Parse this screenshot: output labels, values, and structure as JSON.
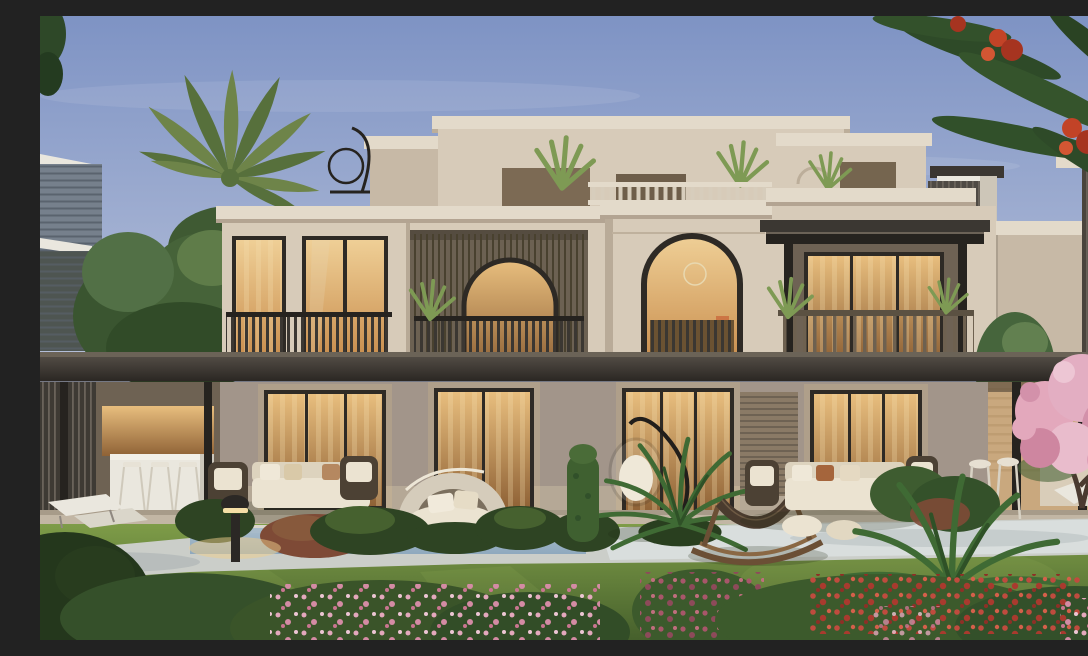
{
  "scene": {
    "type": "photorealistic architectural exterior rendering",
    "setting": "Twilight garden view of a modern two-storey stucco villa with recessed roof-terrace level, warm interior lighting, pergolas and landscaped lawn",
    "lighting": "dusk sky, warm amber light glowing through all glazing, bollard path light lit",
    "elements": [
      "sky at dusk",
      "neighbor building left with louvers",
      "neighbor villa right with louver panel",
      "palm tree",
      "green trees",
      "flame tree branch with red blossoms overhanging top right",
      "villa penthouse level with parapet plants",
      "rooftop hanging chair silhouette",
      "roof balustrade",
      "left wing with two lit windows and slatted balcony railing",
      "recessed loggia with arched opening",
      "center tower with large arched window and ring chandelier",
      "right wing covered balcony with posts and wood railing",
      "continuous dark shade canopy",
      "four lit sliding glass doors on ground floor",
      "roller shade panel",
      "left pergola with bar counter and stools",
      "right pergola with bar stools and planter",
      "stone terrace",
      "reflecting pool strip",
      "light garden path",
      "lawn",
      "canopy daybed",
      "hanging egg chair",
      "wooden hammock",
      "outdoor sofa sets with wicker chairs",
      "sun loungers",
      "bollard light with warm glow",
      "topiary column",
      "two large ferns",
      "hedge row",
      "rust shrub",
      "pink blossom tree",
      "flower beds pink red and magenta"
    ]
  },
  "canvas": {
    "width": 1088,
    "height": 624
  },
  "palette": {
    "sky_top": "#7E93C4",
    "sky_bottom": "#BDC6DC",
    "facade_light": "#D7CBB9",
    "facade_mid": "#C7B9A6",
    "facade_shadow": "#A2958A",
    "cornice_light": "#E3DACA",
    "dark_wood": "#3B3732",
    "darker_wood": "#26231F",
    "rail_wood": "#6E6150",
    "frame_dark": "#2E2A25",
    "window_glow_light": "#EFCF96",
    "window_glow": "#C98E4E",
    "window_glow_deep": "#8F6236",
    "grass_light": "#7E9C48",
    "grass_dark": "#46602C",
    "hedge_dark": "#2E4423",
    "fern_green": "#3F6A34",
    "palm_green": "#6E8449",
    "palm_dark": "#57703C",
    "leaf_highlight": "#5C8440",
    "path_light": "#CBCEC9",
    "path_bright": "#DCE0E0",
    "path_shade": "#9BA4A9",
    "pool_blue": "#8FA9BE",
    "blossom_pink": "#E3A8BC",
    "blossom_pink_light": "#EDC6D4",
    "flower_red": "#BF4B3E",
    "flower_magenta": "#A8566A",
    "flame_red": "#C24327",
    "canopy_beige": "#D5CCBB",
    "cushion_cream": "#EBE3D1",
    "terrace_stone": "#C2B6A4",
    "warm_wall": "#C9A87E",
    "neighbor_gray": "#76808C",
    "white_trim": "#EAE7DE",
    "glow_warm": "#F0CE8C",
    "trunk_brown": "#4A3A30",
    "wicker_brown": "#4C4134",
    "rust_shrub": "#7E4A36"
  }
}
